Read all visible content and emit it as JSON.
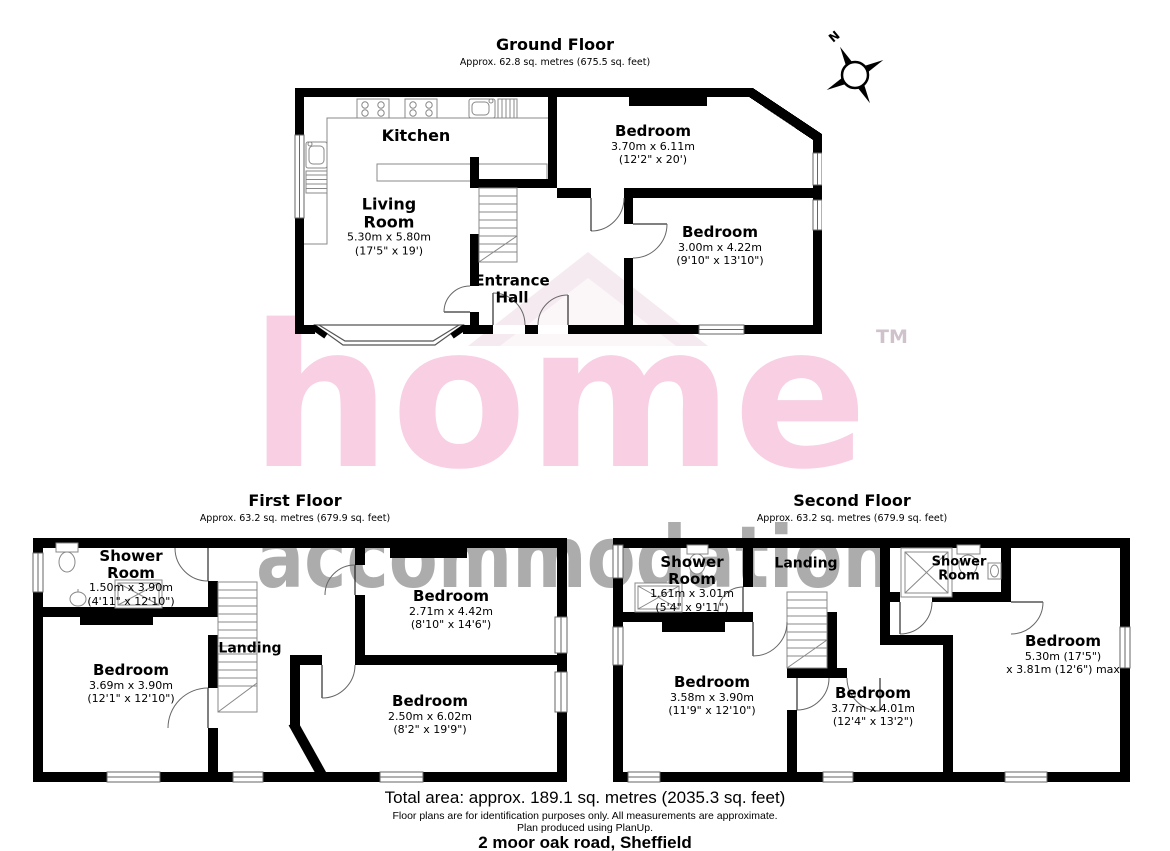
{
  "header": {
    "compass_label": "N"
  },
  "watermark": {
    "brand": "home",
    "tm": "TM",
    "secondary": "accommodation",
    "pink": "#f8cfe3",
    "gray": "#6b6b6b"
  },
  "floors": [
    {
      "title": "Ground Floor",
      "subtitle": "Approx. 62.8 sq. metres (675.5 sq. feet)",
      "rooms": [
        {
          "name": "Kitchen",
          "dims_m": "",
          "dims_ft": ""
        },
        {
          "name": "Living Room",
          "dims_m": "5.30m x 5.80m",
          "dims_ft": "(17'5\" x 19')"
        },
        {
          "name": "Entrance Hall",
          "dims_m": "",
          "dims_ft": ""
        },
        {
          "name": "Bedroom",
          "dims_m": "3.70m x 6.11m",
          "dims_ft": "(12'2\" x 20')"
        },
        {
          "name": "Bedroom",
          "dims_m": "3.00m x 4.22m",
          "dims_ft": "(9'10\" x 13'10\")"
        }
      ]
    },
    {
      "title": "First Floor",
      "subtitle": "Approx. 63.2 sq. metres (679.9 sq. feet)",
      "rooms": [
        {
          "name": "Shower Room",
          "dims_m": "1.50m x 3.90m",
          "dims_ft": "(4'11\" x 12'10\")"
        },
        {
          "name": "Landing",
          "dims_m": "",
          "dims_ft": ""
        },
        {
          "name": "Bedroom",
          "dims_m": "3.69m x 3.90m",
          "dims_ft": "(12'1\" x 12'10\")"
        },
        {
          "name": "Bedroom",
          "dims_m": "2.71m x 4.42m",
          "dims_ft": "(8'10\" x 14'6\")"
        },
        {
          "name": "Bedroom",
          "dims_m": "2.50m x 6.02m",
          "dims_ft": "(8'2\" x 19'9\")"
        }
      ]
    },
    {
      "title": "Second Floor",
      "subtitle": "Approx. 63.2 sq. metres (679.9 sq. feet)",
      "rooms": [
        {
          "name": "Shower Room",
          "dims_m": "1.61m x 3.01m",
          "dims_ft": "(5'4\" x 9'11\")"
        },
        {
          "name": "Landing",
          "dims_m": "",
          "dims_ft": ""
        },
        {
          "name": "Shower Room",
          "dims_m": "",
          "dims_ft": ""
        },
        {
          "name": "Bedroom",
          "dims_m": "3.58m x 3.90m",
          "dims_ft": "(11'9\" x 12'10\")"
        },
        {
          "name": "Bedroom",
          "dims_m": "3.77m x 4.01m",
          "dims_ft": "(12'4\" x 13'2\")"
        },
        {
          "name": "Bedroom",
          "dims_m": "5.30m (17'5\")",
          "dims_ft": "x 3.81m (12'6\") max"
        }
      ]
    }
  ],
  "footer": {
    "total_area": "Total area: approx. 189.1 sq. metres (2035.3 sq. feet)",
    "disclaimer_line1": "Floor plans are for identification purposes only. All measurements are approximate.",
    "disclaimer_line2": "Plan produced using PlanUp.",
    "address": "2 moor oak road, Sheffield"
  },
  "colors": {
    "wall": "#000000"
  }
}
